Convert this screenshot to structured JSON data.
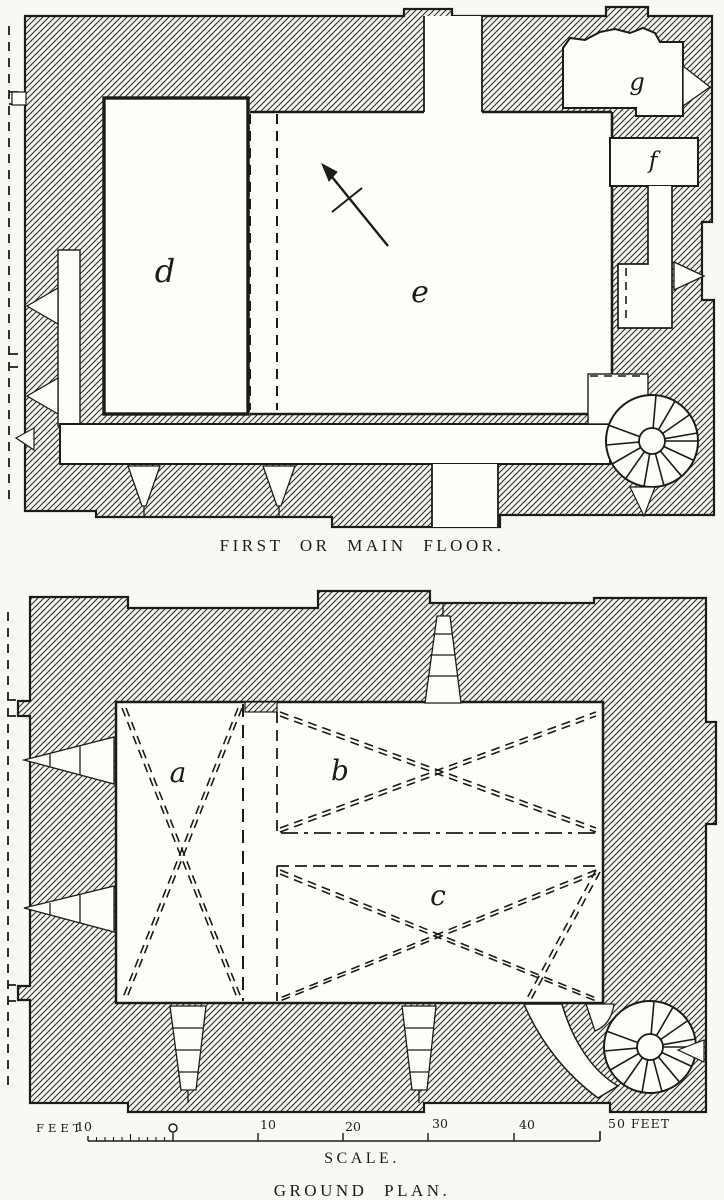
{
  "page": {
    "background": "#f9f8f3",
    "ink": "#1b1b1b",
    "wall_fill": "#f4f3ec"
  },
  "first_floor": {
    "caption": "FIRST OR MAIN FLOOR.",
    "rooms": {
      "d": "d",
      "e": "e",
      "f": "f",
      "g": "g"
    },
    "features": [
      "north-arrow",
      "spiral-stair",
      "loopholes",
      "gallery"
    ]
  },
  "ground": {
    "caption": "GROUND PLAN.",
    "rooms": {
      "a": "a",
      "b": "b",
      "c": "c"
    },
    "features": [
      "spiral-stair",
      "stepped-loopholes",
      "cross-bracing"
    ]
  },
  "scale": {
    "left_label": "FEET",
    "left_tick_label": "10",
    "zero_label": "0",
    "ticks": [
      "10",
      "20",
      "30",
      "40"
    ],
    "end_label": "50 FEET",
    "caption": "SCALE."
  }
}
